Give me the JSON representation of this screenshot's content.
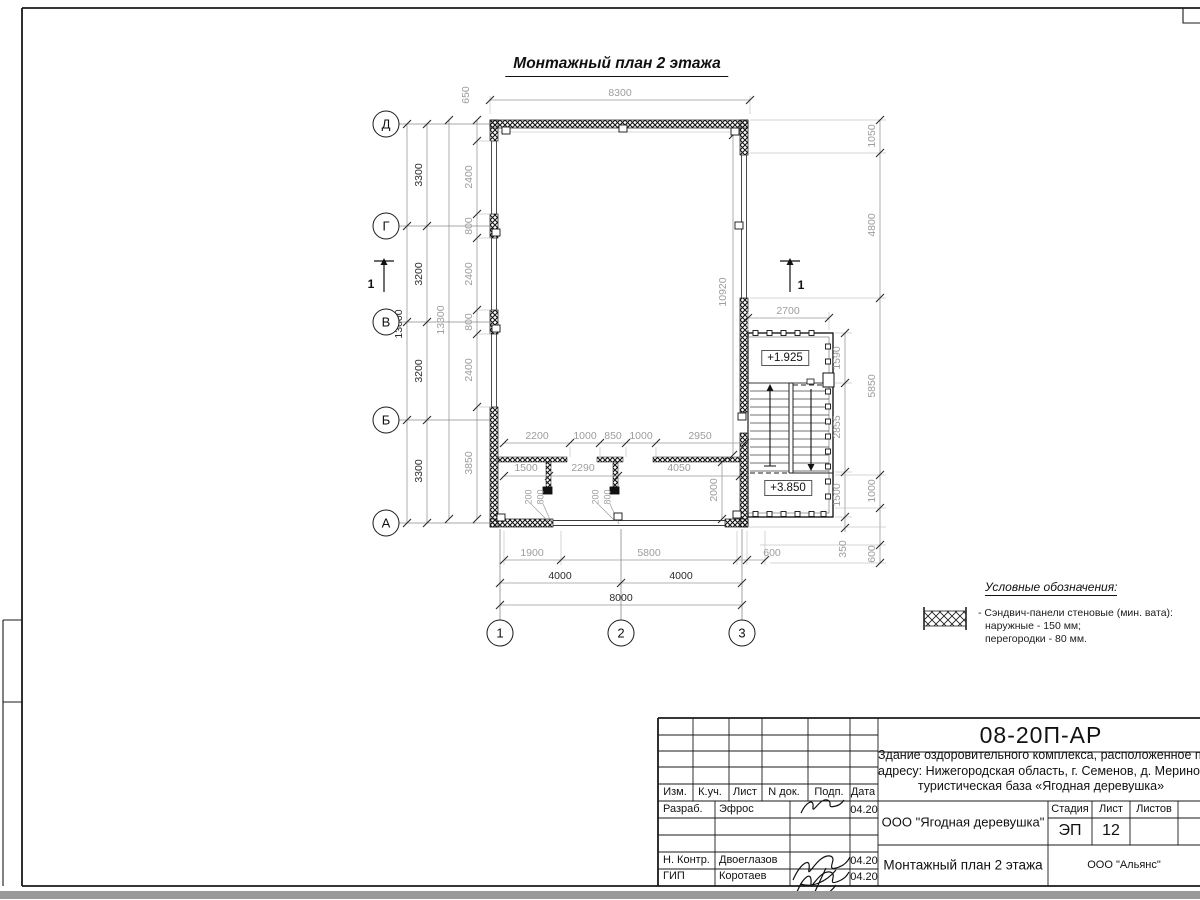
{
  "plan": {
    "title": "Монтажный план 2 этажа",
    "axes_left": [
      {
        "t": "Д",
        "x": 386,
        "y": 124
      },
      {
        "t": "Г",
        "x": 386,
        "y": 226
      },
      {
        "t": "В",
        "x": 386,
        "y": 322
      },
      {
        "t": "Б",
        "x": 386,
        "y": 420
      },
      {
        "t": "А",
        "x": 386,
        "y": 523
      }
    ],
    "axes_bottom": [
      {
        "t": "1",
        "x": 500,
        "y": 633
      },
      {
        "t": "2",
        "x": 621,
        "y": 633
      },
      {
        "t": "3",
        "x": 742,
        "y": 633
      }
    ],
    "section_marks": [
      {
        "t": "1",
        "x": 371,
        "y": 284
      },
      {
        "t": "1",
        "x": 801,
        "y": 285
      }
    ],
    "levels": {
      "upper": {
        "t": "+1.925"
      },
      "lower": {
        "t": "+3.850"
      }
    },
    "dims": [
      {
        "t": "8300",
        "x": 620,
        "y": 93
      },
      {
        "t": "650",
        "x": 466,
        "y": 95,
        "v": 1
      },
      {
        "t": "2400",
        "x": 469,
        "y": 177,
        "v": 1
      },
      {
        "t": "800",
        "x": 469,
        "y": 226,
        "v": 1
      },
      {
        "t": "2400",
        "x": 469,
        "y": 274,
        "v": 1
      },
      {
        "t": "800",
        "x": 469,
        "y": 322,
        "v": 1
      },
      {
        "t": "2400",
        "x": 469,
        "y": 370,
        "v": 1
      },
      {
        "t": "3850",
        "x": 469,
        "y": 463,
        "v": 1
      },
      {
        "t": "13300",
        "x": 441,
        "y": 320,
        "v": 1
      },
      {
        "t": "3300",
        "x": 419,
        "y": 175,
        "v": 1,
        "b": 1
      },
      {
        "t": "3200",
        "x": 419,
        "y": 274,
        "v": 1,
        "b": 1
      },
      {
        "t": "3200",
        "x": 419,
        "y": 371,
        "v": 1,
        "b": 1
      },
      {
        "t": "3300",
        "x": 419,
        "y": 471,
        "v": 1,
        "b": 1
      },
      {
        "t": "13000",
        "x": 399,
        "y": 324,
        "v": 1,
        "b": 1
      },
      {
        "t": "1050",
        "x": 872,
        "y": 136,
        "v": 1
      },
      {
        "t": "4800",
        "x": 872,
        "y": 225,
        "v": 1
      },
      {
        "t": "5850",
        "x": 872,
        "y": 386,
        "v": 1
      },
      {
        "t": "1000",
        "x": 872,
        "y": 491,
        "v": 1
      },
      {
        "t": "600",
        "x": 872,
        "y": 554,
        "v": 1
      },
      {
        "t": "1590",
        "x": 837,
        "y": 358,
        "v": 1
      },
      {
        "t": "2855",
        "x": 837,
        "y": 427,
        "v": 1
      },
      {
        "t": "1500",
        "x": 837,
        "y": 495,
        "v": 1
      },
      {
        "t": "350",
        "x": 843,
        "y": 549,
        "v": 1
      },
      {
        "t": "2700",
        "x": 788,
        "y": 311
      },
      {
        "t": "10920",
        "x": 723,
        "y": 292,
        "v": 1
      },
      {
        "t": "2200",
        "x": 537,
        "y": 436
      },
      {
        "t": "1000",
        "x": 585,
        "y": 436
      },
      {
        "t": "850",
        "x": 613,
        "y": 436
      },
      {
        "t": "1000",
        "x": 641,
        "y": 436
      },
      {
        "t": "2950",
        "x": 700,
        "y": 436
      },
      {
        "t": "1500",
        "x": 526,
        "y": 468
      },
      {
        "t": "2290",
        "x": 583,
        "y": 468
      },
      {
        "t": "4050",
        "x": 679,
        "y": 468
      },
      {
        "t": "200",
        "x": 529,
        "y": 497,
        "v": 1,
        "s": 1
      },
      {
        "t": "800",
        "x": 541,
        "y": 497,
        "v": 1,
        "s": 1
      },
      {
        "t": "200",
        "x": 596,
        "y": 497,
        "v": 1,
        "s": 1
      },
      {
        "t": "800",
        "x": 608,
        "y": 497,
        "v": 1,
        "s": 1
      },
      {
        "t": "2000",
        "x": 714,
        "y": 490,
        "v": 1
      },
      {
        "t": "1900",
        "x": 532,
        "y": 553
      },
      {
        "t": "5800",
        "x": 649,
        "y": 553
      },
      {
        "t": "600",
        "x": 772,
        "y": 553
      },
      {
        "t": "4000",
        "x": 560,
        "y": 576,
        "b": 1
      },
      {
        "t": "4000",
        "x": 681,
        "y": 576,
        "b": 1
      },
      {
        "t": "8000",
        "x": 621,
        "y": 598,
        "b": 1
      }
    ]
  },
  "legend": {
    "title": "Условные обозначения:",
    "item": "- Сэндвич-панели стеновые (мин. вата):",
    "item2": "наружные - 150 мм;",
    "item3": "перегородки - 80 мм."
  },
  "titleblock": {
    "code": "08-20П-АР",
    "desc_lines": [
      "Здание оздоровительного комплекса, расположенное по",
      "адресу: Нижегородская область, г. Семенов, д. Мериново,",
      "туристическая база «Ягодная деревушка»"
    ],
    "header": [
      "Изм.",
      "К.уч.",
      "Лист",
      "N док.",
      "Подп.",
      "Дата"
    ],
    "rows": [
      {
        "role": "Разраб.",
        "name": "Эфрос",
        "date": "04.20",
        "y": 810
      },
      {
        "role": "Н. Контр.",
        "name": "Двоеглазов",
        "date": "04.20",
        "y": 861
      },
      {
        "role": "ГИП",
        "name": "Коротаев",
        "date": "04.20",
        "y": 877
      }
    ],
    "org": "ООО \"Ягодная деревушка\"",
    "stage_labels": [
      "Стадия",
      "Лист",
      "Листов"
    ],
    "stage": "ЭП",
    "sheet_no": "12",
    "doc_title": "Монтажный план 2 этажа",
    "contractor": "ООО \"Альянс\""
  }
}
